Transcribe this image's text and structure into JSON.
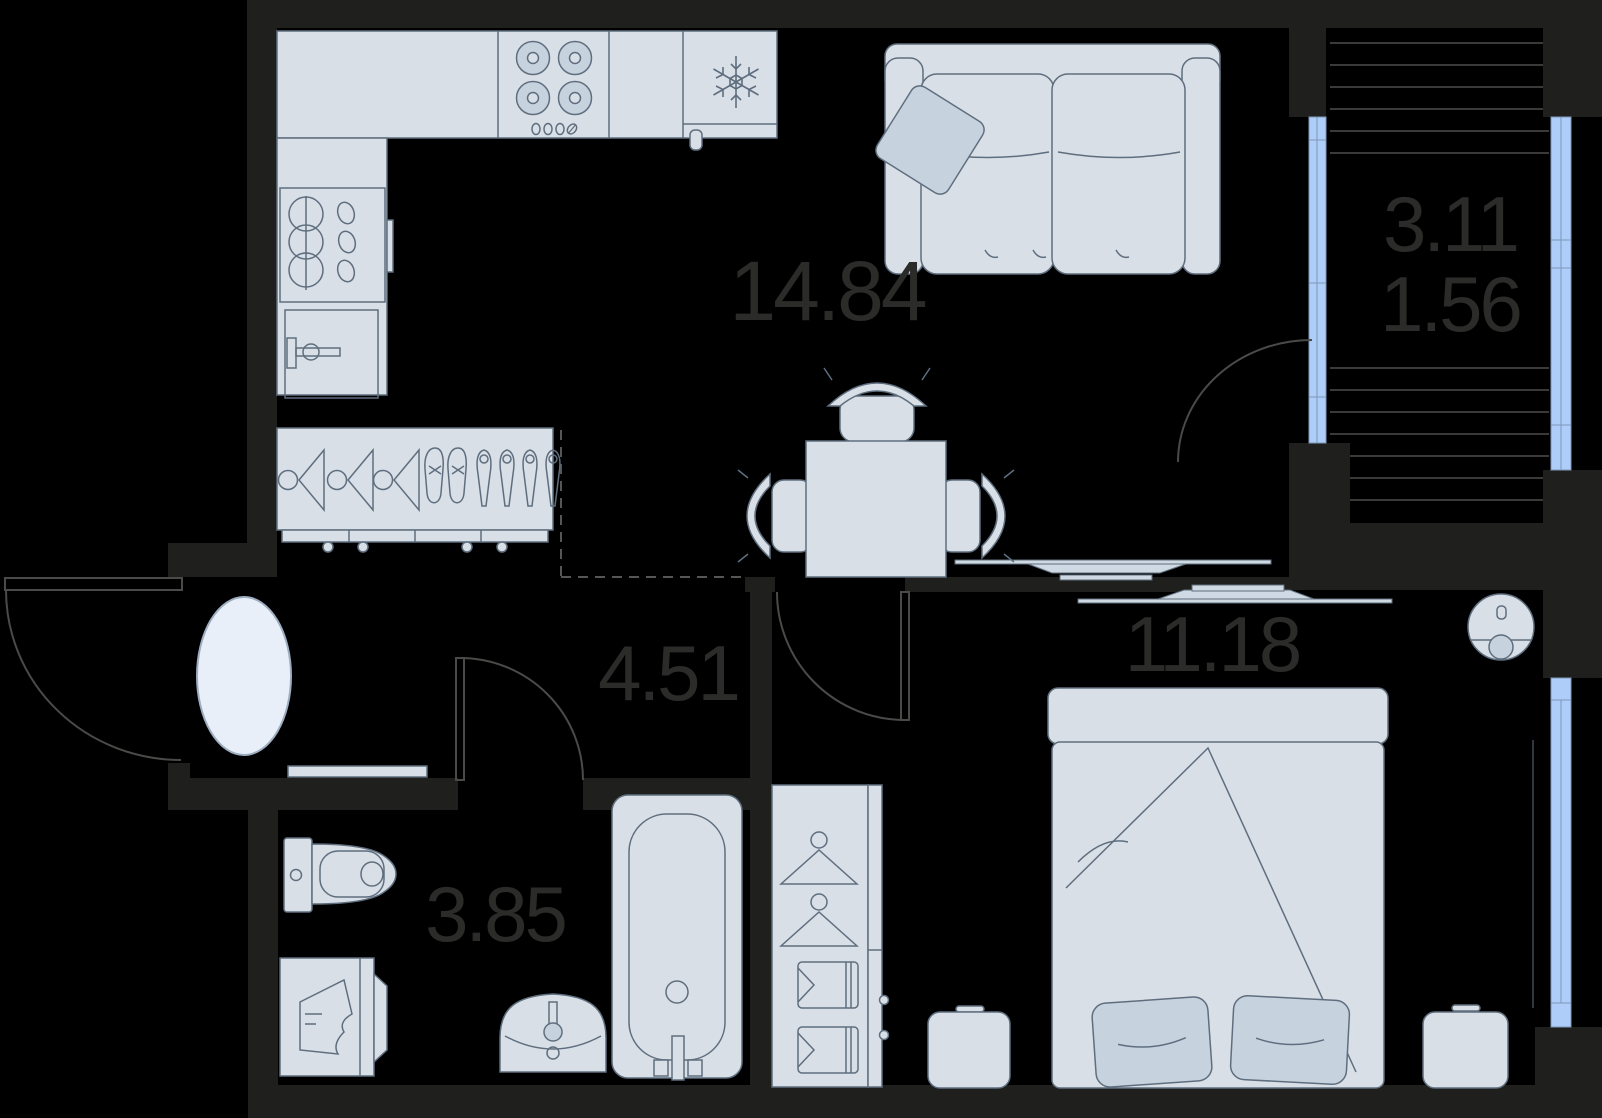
{
  "title": "apartment-floor-plan",
  "areas": {
    "living": "14.84",
    "hallway": "4.51",
    "bathroom": "3.85",
    "bedroom": "11.18",
    "balcony": "3.11",
    "balcony_reduced": "1.56"
  },
  "colors": {
    "background": "#000000",
    "wall": "#1f1f1e",
    "furniture_fill": "#d8dfe7",
    "furniture_soft": "#c7d2df",
    "outline": "#5f6e7e",
    "glazing": "#aecdf8",
    "glazing_stroke": "#7f98ba",
    "door_swing": "#4a4a48",
    "balcony_slats": "#4e4e4c",
    "label_text": "#2b2b29",
    "rug_fill": "#e9eff8"
  },
  "icons": {
    "stove-burners-icon": "four circles with knobs",
    "snowflake-icon": "fridge snowflake",
    "dish-stack-icon": "stacked bowls in sink cabinet",
    "oven-icon": "door with handle",
    "hanger-icon": "clothes hanger",
    "shoes-icon": "shoes pairs",
    "door-swing-icon": "quarter arc",
    "rug-icon": "oval rug",
    "toilet-icon": "toilet with tank",
    "washing-machine-icon": "machine with laundry",
    "sink-icon": "wash basin",
    "bathtub-icon": "bathtub",
    "sofa-icon": "two-seat sofa with pillow",
    "dining-table-icon": "square table with chairs",
    "radiator-icon": "wall radiator",
    "bed-icon": "double bed with pillows",
    "wardrobe-icon": "closet with hangers and shirts",
    "robot-vacuum-icon": "round robot vacuum",
    "window-icon": "blue glazing strip"
  }
}
